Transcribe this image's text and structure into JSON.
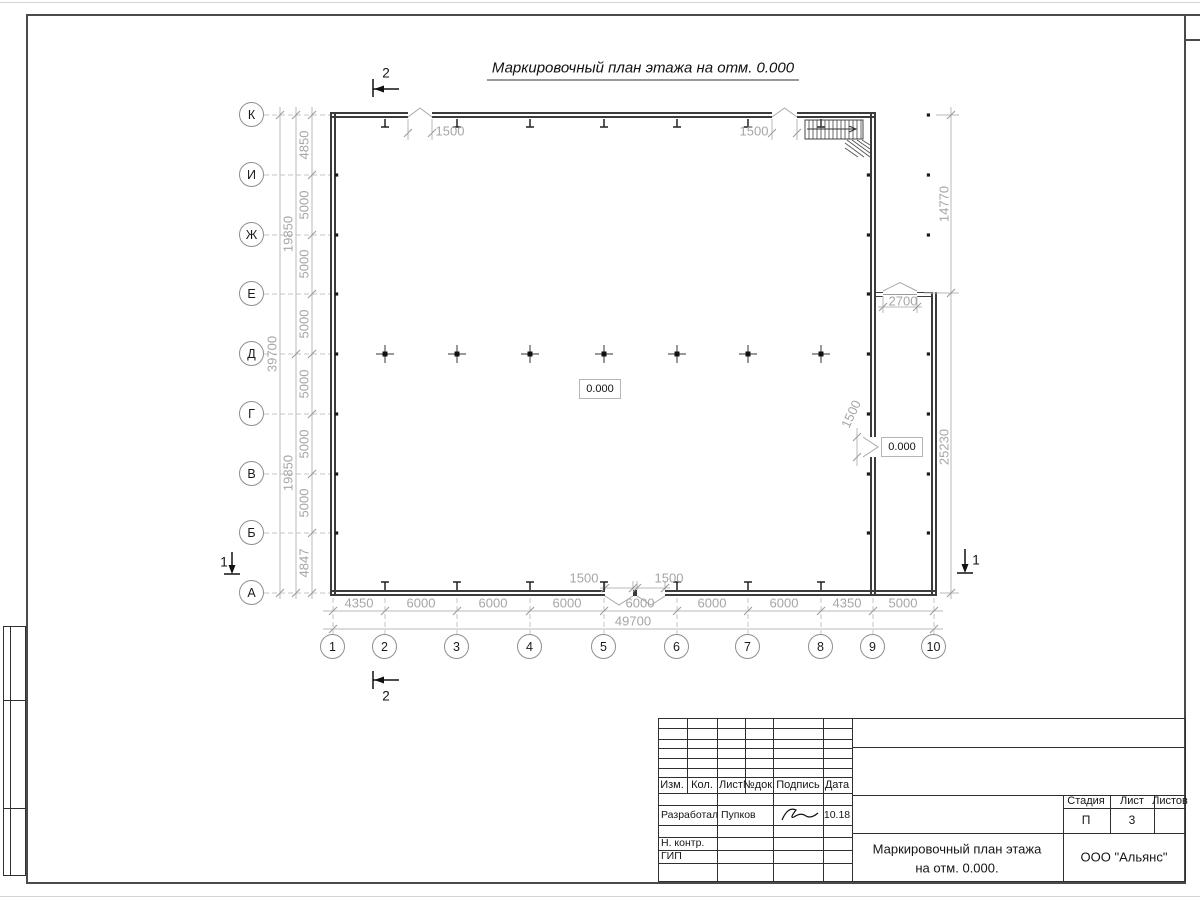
{
  "drawing_title": "Маркировочный план этажа на отм. 0.000",
  "plan": {
    "row_axes": [
      "К",
      "И",
      "Ж",
      "Е",
      "Д",
      "Г",
      "В",
      "Б",
      "А"
    ],
    "col_axes": [
      "1",
      "2",
      "3",
      "4",
      "5",
      "6",
      "7",
      "8",
      "9",
      "10"
    ],
    "left_dims": [
      "4850",
      "5000",
      "5000",
      "5000",
      "5000",
      "5000",
      "5000",
      "4847"
    ],
    "left_subtotals": [
      "19850",
      "19850"
    ],
    "left_total": "39700",
    "bottom_dims": [
      "4350",
      "6000",
      "6000",
      "6000",
      "6000",
      "6000",
      "6000",
      "4350",
      "5000"
    ],
    "bottom_total": "49700",
    "right_dims": [
      "14770",
      "25230"
    ],
    "door_dims": {
      "top_left": "1500",
      "top_right": "1500",
      "bottom_left": "1500",
      "bottom_right": "1500",
      "annex_top": "2700",
      "annex_side": "1500"
    },
    "elevation_marks": [
      "0.000",
      "0.000"
    ],
    "section_marks": {
      "top": "2",
      "bottom": "2",
      "left": "1",
      "right": "1"
    }
  },
  "title_block": {
    "header_cols": [
      "Изм.",
      "Кол.",
      "Лист",
      "№док.",
      "Подпись",
      "Дата"
    ],
    "rows": [
      {
        "role": "Разработал",
        "name": "Пупков",
        "date": "10.18"
      },
      {
        "role": "Н. контр."
      },
      {
        "role": "ГИП"
      }
    ],
    "doc_title_line1": "Маркировочный план этажа",
    "doc_title_line2": "на отм. 0.000.",
    "company": "ООО \"Альянс\"",
    "stage_label": "Стадия",
    "stage_value": "П",
    "sheet_label": "Лист",
    "sheet_value": "3",
    "sheets_label": "Листов",
    "sheets_value": ""
  }
}
